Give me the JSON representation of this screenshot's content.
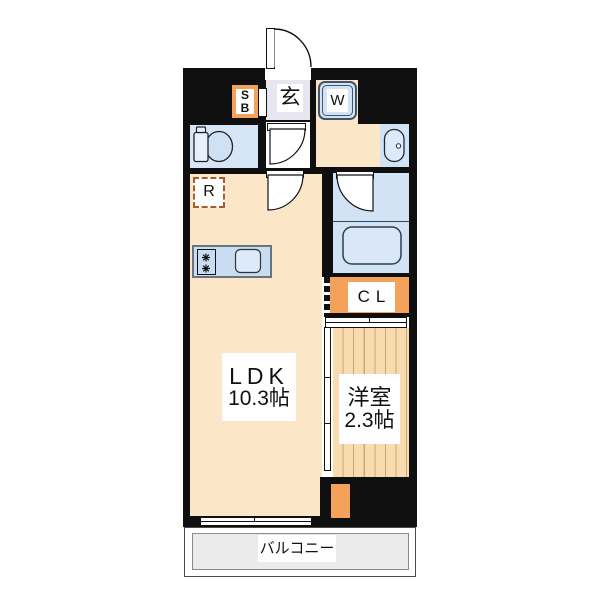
{
  "title": "apartment-floor-plan",
  "colors": {
    "wall": "#0f0f0f",
    "floor_cream": "#fce6c8",
    "entrance_lavender": "#e6e5f0",
    "water_blue": "#d2e3f6",
    "counter_blue": "#c8ddf2",
    "accent_orange": "#f4a159",
    "western_floor": "#f8dcb0",
    "western_stripe": "#c9a87c",
    "balcony_gray": "#ebebeb",
    "fridge_dash_brown": "#a65e2e"
  },
  "rooms": {
    "entrance": {
      "label": "玄"
    },
    "shoe_box": {
      "line1": "S",
      "line2": "B"
    },
    "washer": {
      "label": "W"
    },
    "refrigerator": {
      "label": "R"
    },
    "closet": {
      "label": "CL"
    },
    "ldk": {
      "label": "LDK",
      "size": "10.3帖"
    },
    "western_room": {
      "label": "洋室",
      "size": "2.3帖"
    },
    "balcony": {
      "label": "バルコニー"
    }
  }
}
